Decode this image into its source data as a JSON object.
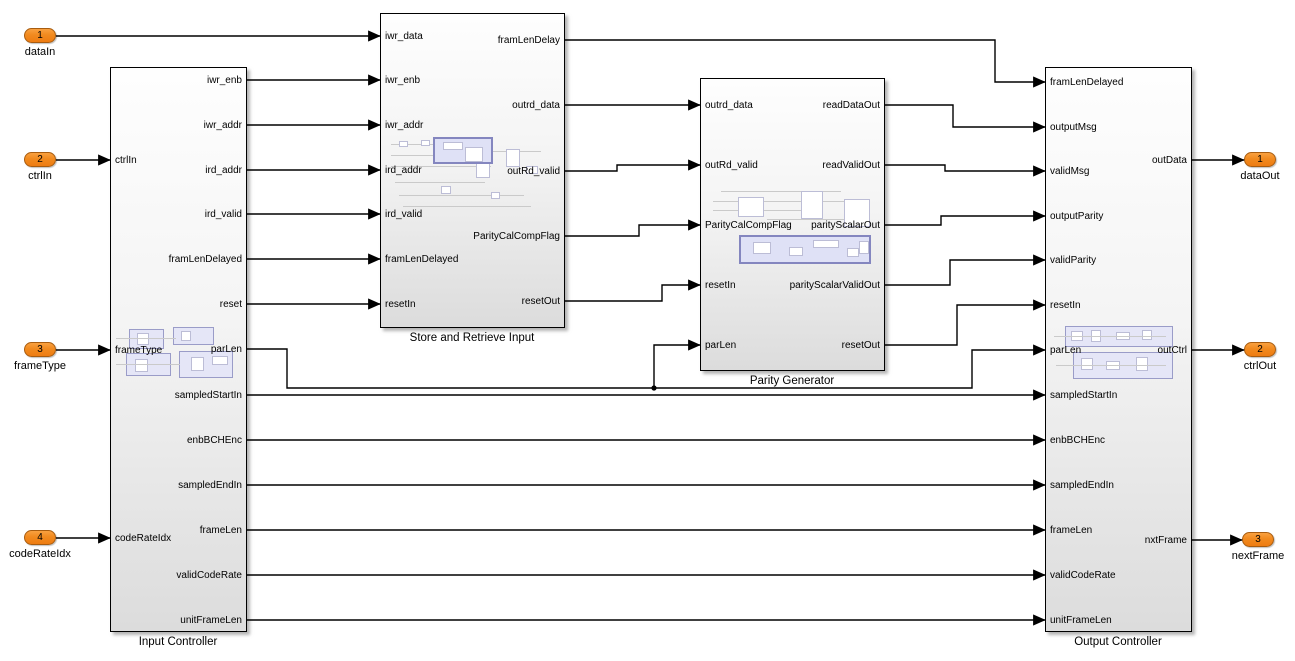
{
  "diagram": {
    "inports": [
      {
        "number": "1",
        "label": "dataIn"
      },
      {
        "number": "2",
        "label": "ctrlIn"
      },
      {
        "number": "3",
        "label": "frameType"
      },
      {
        "number": "4",
        "label": "codeRateIdx"
      }
    ],
    "outports": [
      {
        "number": "1",
        "label": "dataOut"
      },
      {
        "number": "2",
        "label": "ctrlOut"
      },
      {
        "number": "3",
        "label": "nextFrame"
      }
    ],
    "blocks": {
      "input_controller": {
        "name": "Input Controller",
        "inputs": [
          "ctrlIn",
          "frameType",
          "codeRateIdx"
        ],
        "outputs": [
          "iwr_enb",
          "iwr_addr",
          "ird_addr",
          "ird_valid",
          "framLenDelayed",
          "reset",
          "parLen",
          "sampledStartIn",
          "enbBCHEnc",
          "sampledEndIn",
          "frameLen",
          "validCodeRate",
          "unitFrameLen"
        ]
      },
      "store_retrieve": {
        "name": "Store and Retrieve Input",
        "inputs": [
          "iwr_data",
          "iwr_enb",
          "iwr_addr",
          "ird_addr",
          "ird_valid",
          "framLenDelayed",
          "resetIn"
        ],
        "outputs": [
          "framLenDelay",
          "outrd_data",
          "outRd_valid",
          "ParityCalCompFlag",
          "resetOut"
        ]
      },
      "parity_generator": {
        "name": "Parity Generator",
        "inputs": [
          "outrd_data",
          "outRd_valid",
          "ParityCalCompFlag",
          "resetIn",
          "parLen"
        ],
        "outputs": [
          "readDataOut",
          "readValidOut",
          "parityScalarOut",
          "parityScalarValidOut",
          "resetOut"
        ]
      },
      "output_controller": {
        "name": "Output Controller",
        "inputs": [
          "framLenDelayed",
          "outputMsg",
          "validMsg",
          "outputParity",
          "validParity",
          "resetIn",
          "parLen",
          "sampledStartIn",
          "enbBCHEnc",
          "sampledEndIn",
          "frameLen",
          "validCodeRate",
          "unitFrameLen"
        ],
        "outputs": [
          "outData",
          "outCtrl",
          "nxtFrame"
        ]
      }
    },
    "colors": {
      "inport_fill_top": "#F9A140",
      "inport_fill_bottom": "#EE7C12",
      "inport_border": "#A85C0F",
      "wire": "#000000",
      "block_fill_top": "#FEFEFE",
      "block_fill_bottom": "#DCDCDC",
      "preview_fill": "#E5E6F7",
      "preview_border": "#9A9CC8"
    }
  }
}
